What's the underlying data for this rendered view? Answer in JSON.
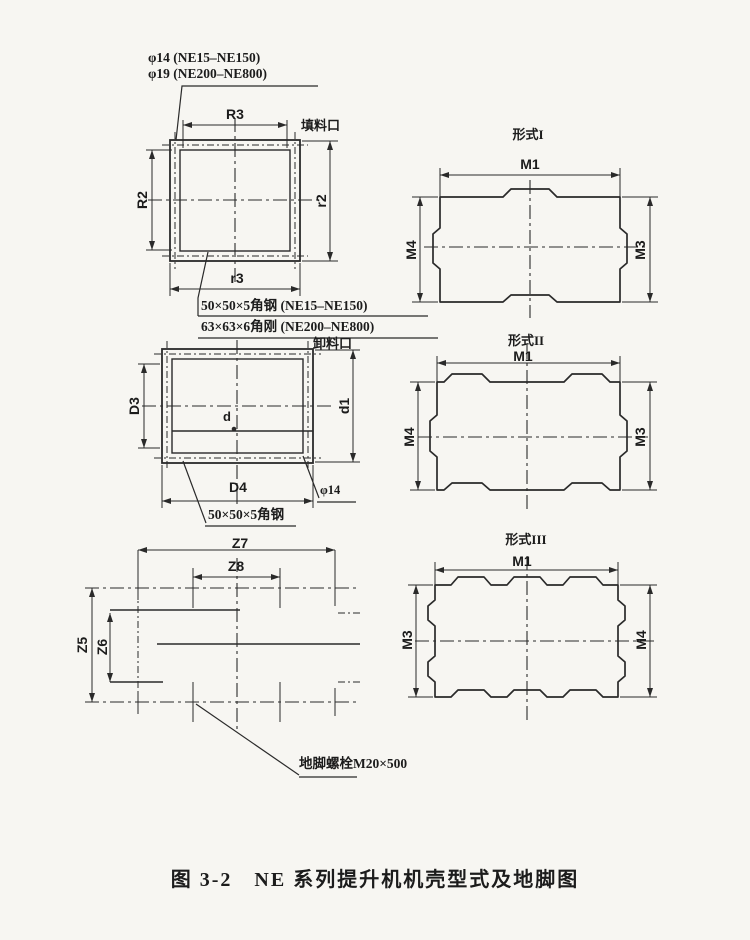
{
  "colors": {
    "paper": "#f7f6f2",
    "ink": "#2a2a2a"
  },
  "caption": "图 3-2　NE 系列提升机机壳型式及地脚图",
  "upper_view": {
    "hole_note_small": "φ14 (NE15–NE150)",
    "hole_note_large": "φ19 (NE200–NE800)",
    "port_label": "填料口",
    "dim_top": "R3",
    "dim_left": "R2",
    "dim_right": "r2",
    "dim_bottom": "r3",
    "angle_steel_note_small": "50×50×5角钢 (NE15–NE150)",
    "angle_steel_note_large": "63×63×6角刚 (NE200–NE800)"
  },
  "lower_view": {
    "port_label": "卸料口",
    "dim_left": "D3",
    "dim_right": "d1",
    "dim_bottom": "D4",
    "dim_inner": "d",
    "hole_label": "φ14",
    "angle_steel_note": "50×50×5角钢"
  },
  "foundation_plan": {
    "dim_outer_width": "Z7",
    "dim_inner_width": "Z8",
    "dim_outer_height": "Z5",
    "dim_inner_height": "Z6",
    "anchor_bolt_note": "地脚螺栓M20×500"
  },
  "casing_forms": [
    {
      "title": "形式I",
      "dim_top": "M1",
      "dim_left": "M4",
      "dim_right": "M3"
    },
    {
      "title": "形式II",
      "dim_top": "M1",
      "dim_left": "M4",
      "dim_right": "M3"
    },
    {
      "title": "形式III",
      "dim_top": "M1",
      "dim_left": "M3",
      "dim_right": "M4"
    }
  ]
}
